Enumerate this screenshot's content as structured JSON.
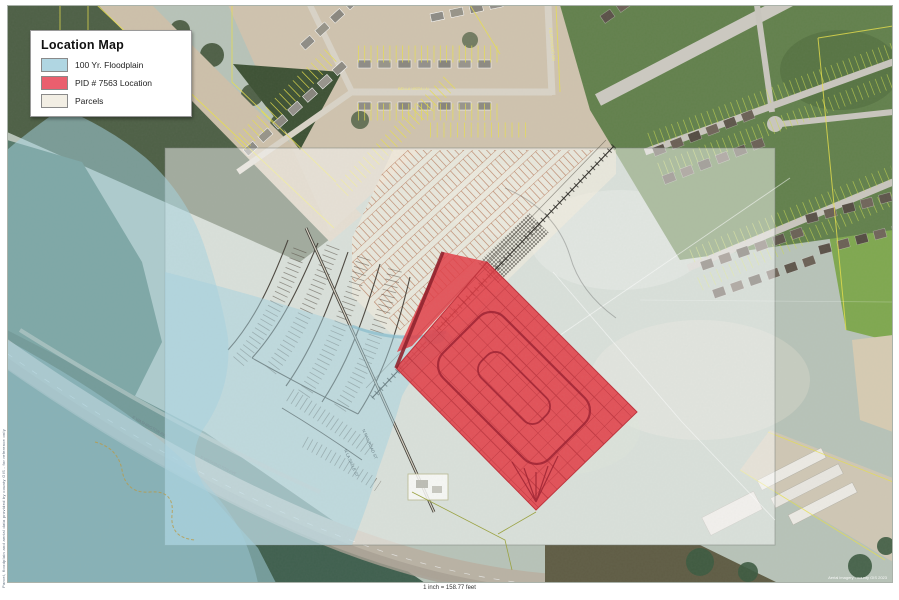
{
  "legend": {
    "title": "Location Map",
    "items": [
      {
        "label": "100 Yr. Floodplain",
        "swatch_style": "background:#b0d6e2"
      },
      {
        "label": "PID # 7563 Location",
        "swatch_style": "background:#ea5f6e"
      },
      {
        "label": "Parcels",
        "swatch_style": "background:#f2eee4"
      }
    ]
  },
  "scale_text": "1 inch = 158.77 feet",
  "attribution_left": "Parcel, floodplain and aerial data provided by county GIS - for reference only",
  "attribution_right": "Aerial imagery - county GIS 2023",
  "road_labels": {
    "road_main": "N LA SALLE ST",
    "road_main2": "N RAILROAD ST",
    "highway1": "E WASHINGTON AVE",
    "highway2": "E WASHINGTON AVE",
    "sub1": "BELLA VISTA LN",
    "sub2": "HEARTWOOD DR"
  },
  "colors": {
    "floodplain": "#a5d2e0",
    "pid_fill": "#e23c45",
    "pid_lines": "#9e2030",
    "overlay_sheet": "rgba(255,255,255,0.48)"
  }
}
